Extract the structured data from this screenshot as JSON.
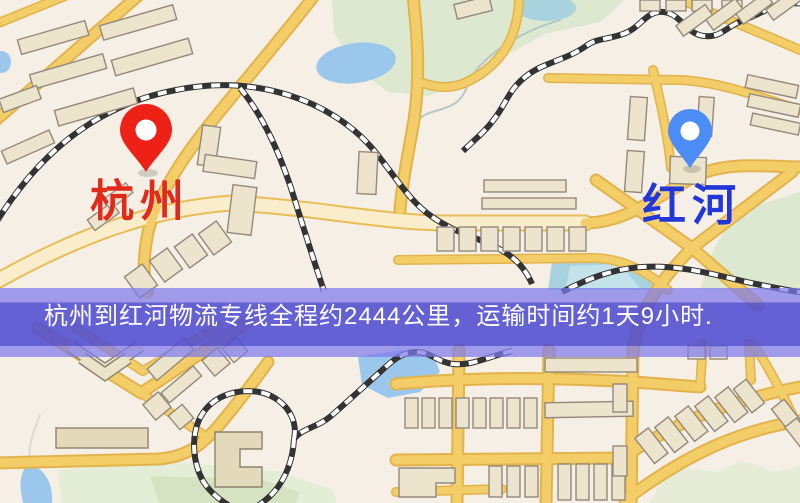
{
  "banner": {
    "text": "杭州到红河物流专线全程约2444公里，运输时间约1天9小时."
  },
  "route": {
    "origin": "杭州",
    "destination": "红河",
    "distance": "约2444公里",
    "duration": "约1天9小时"
  },
  "markers": {
    "origin": {
      "label": "杭州",
      "pin_color": "#ee2117",
      "label_color": "#e02a1a"
    },
    "destination": {
      "label": "红河",
      "pin_color": "#4b8cf5",
      "label_color": "#2336d8"
    }
  },
  "map_colors": {
    "background": "#f6efe6",
    "road_fill": "#f3cd68",
    "road_casing": "#e3b34b",
    "major_road_fill": "#f9edcb",
    "building": "#ece4cd",
    "park": "#dde8d0",
    "water": "#9cc7ec",
    "railway": "#333333",
    "banner_overlay": "#504dd2"
  }
}
